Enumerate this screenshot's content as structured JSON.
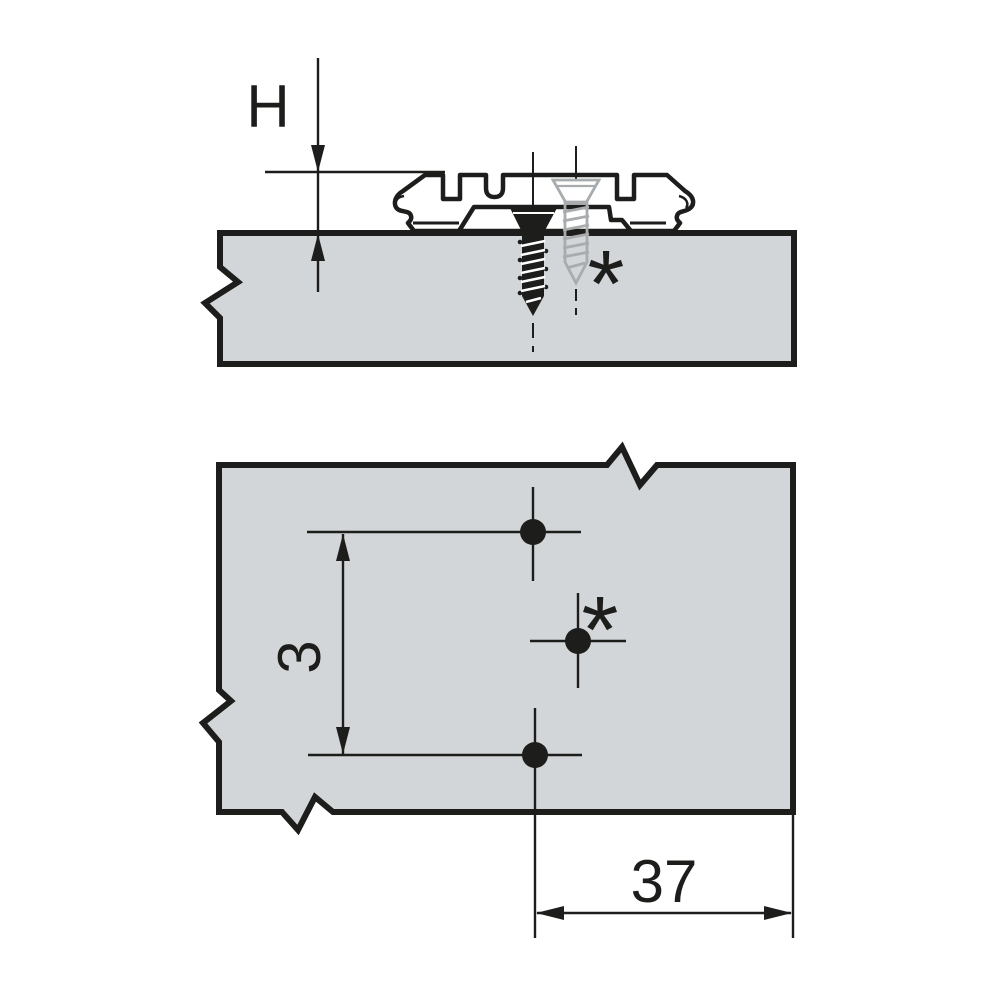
{
  "diagram": {
    "type": "technical-drawing",
    "views": {
      "side_view": {
        "height_dimension_label": "H",
        "alternative_screw_marker": "*"
      },
      "plan_view": {
        "hole_spacing_dimension_label": "3",
        "edge_distance_dimension_label": "37",
        "alternative_hole_marker": "*"
      }
    },
    "colors": {
      "background": "#ffffff",
      "panel_fill": "#d3d6d8",
      "line": "#1d1d1b",
      "alternative_screw": "#a8acae"
    }
  }
}
